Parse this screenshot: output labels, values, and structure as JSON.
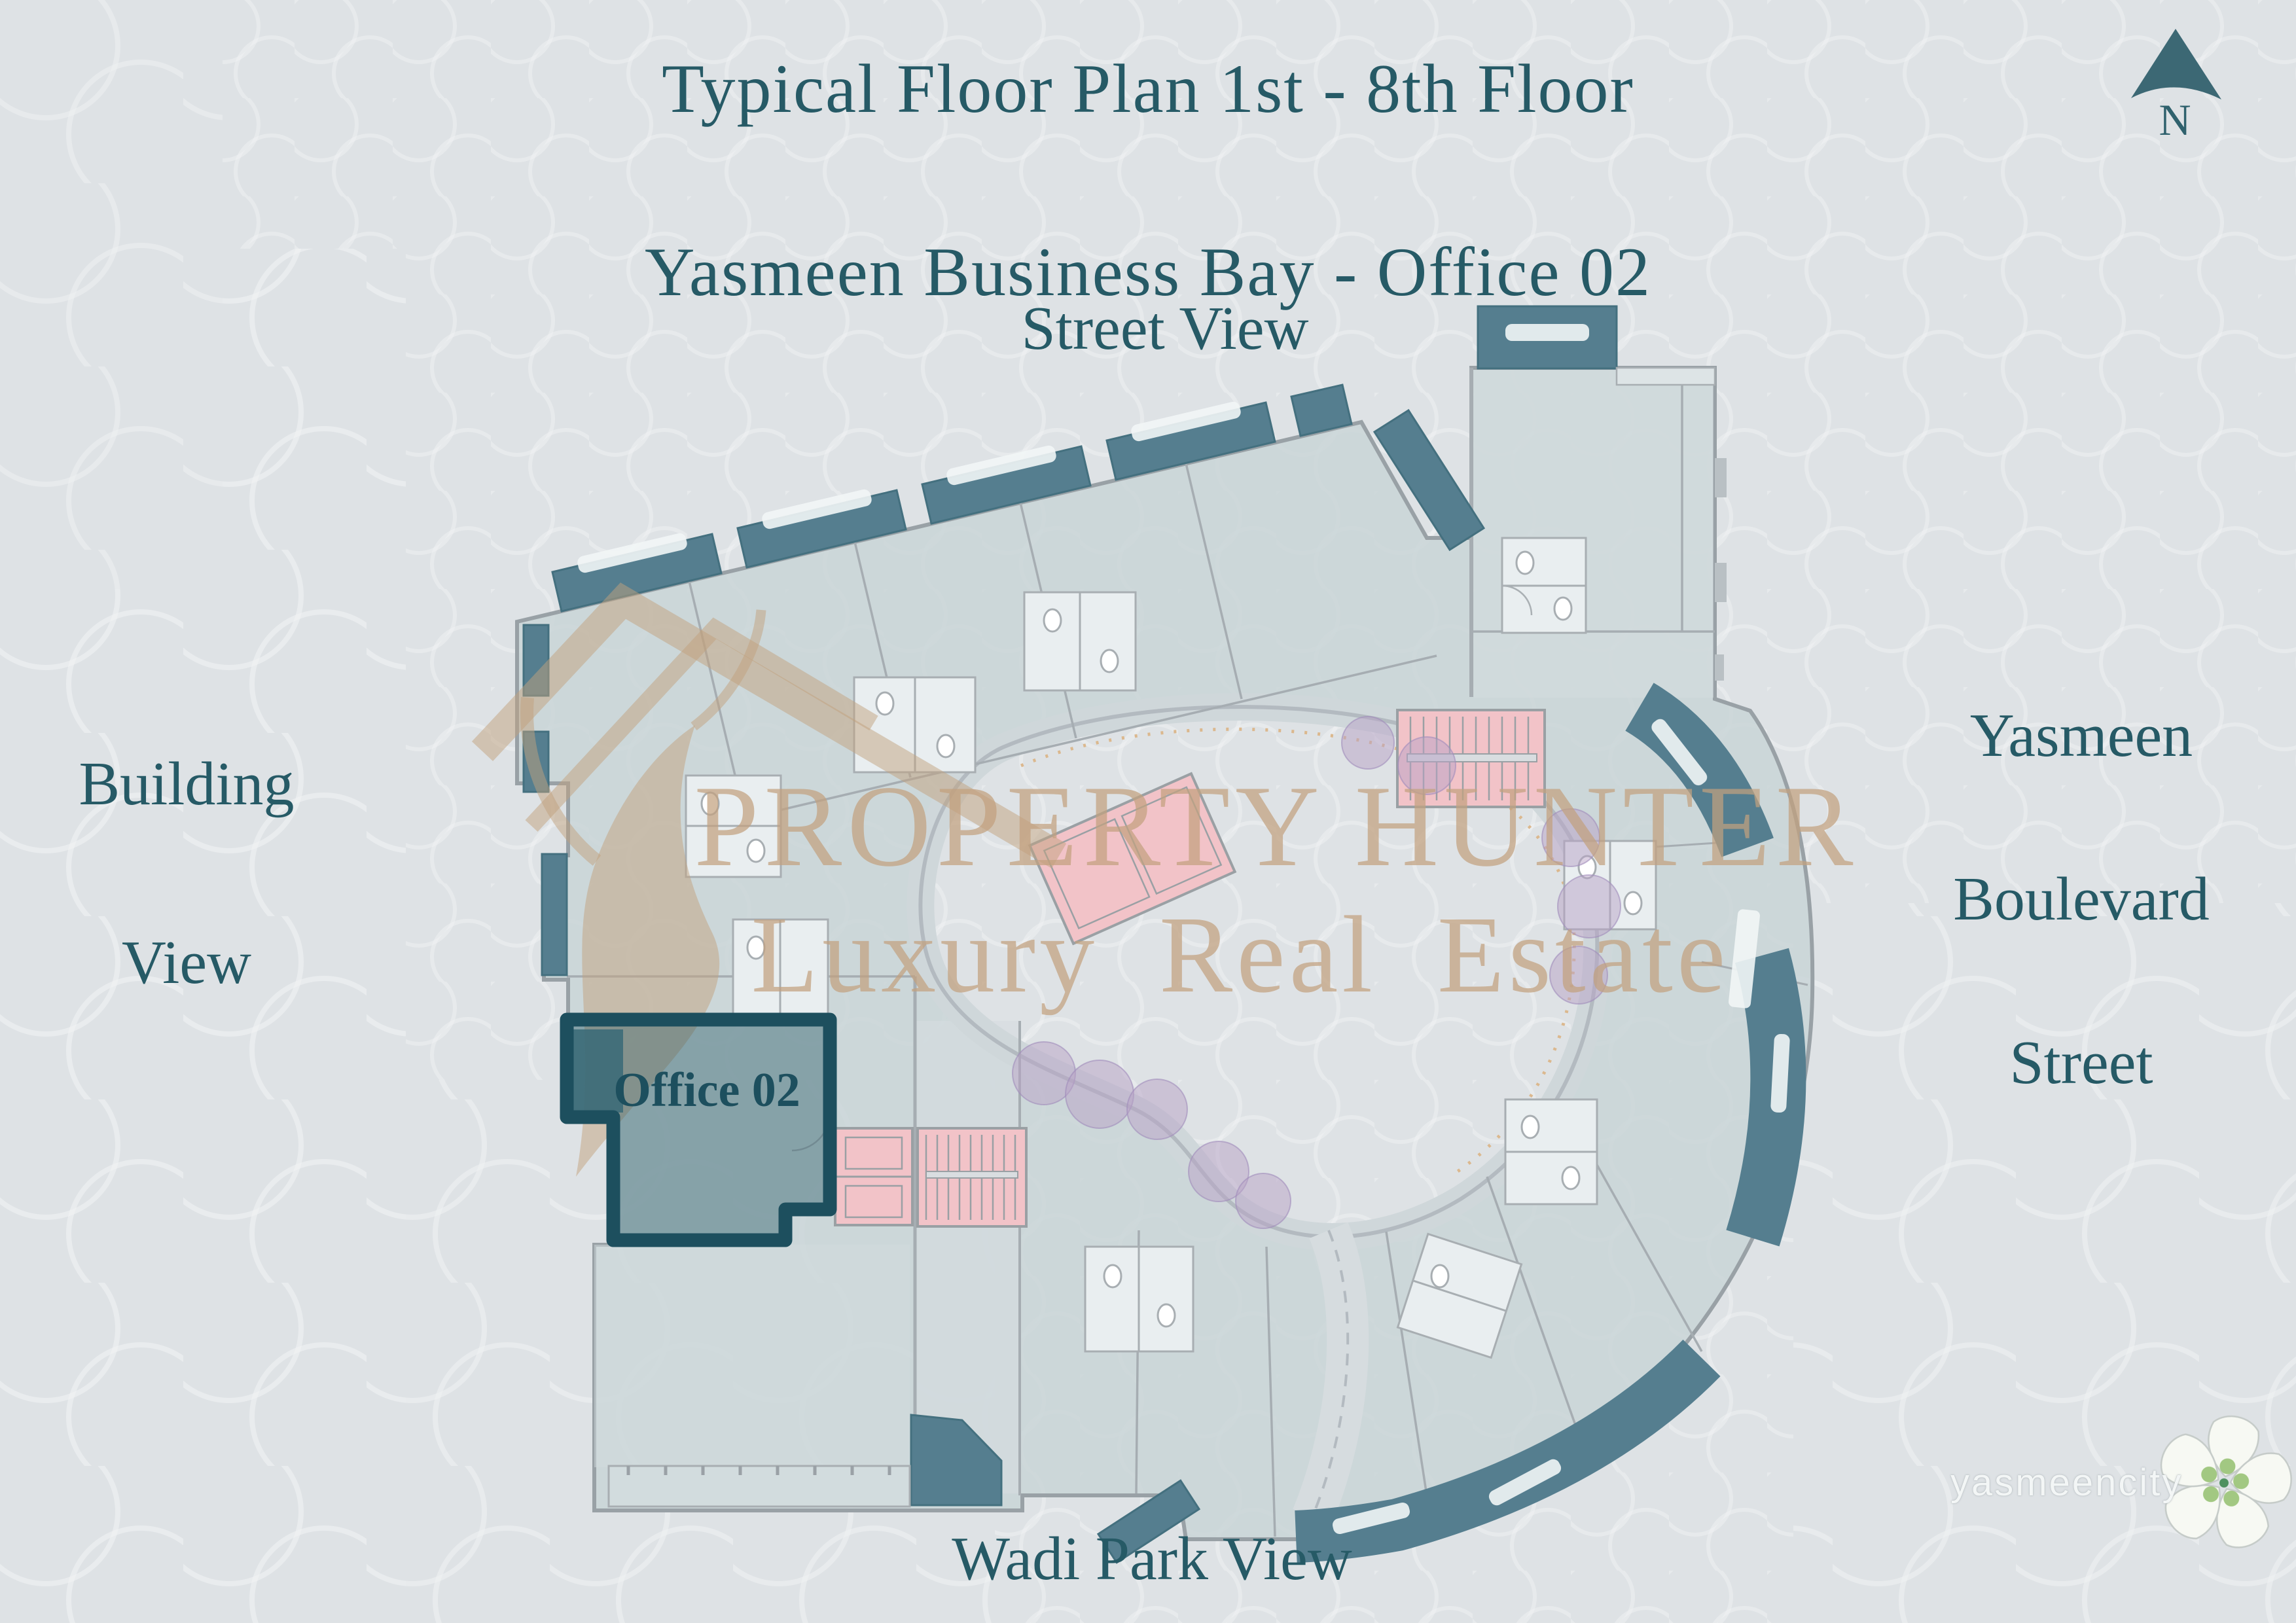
{
  "title": {
    "line1": "Typical Floor Plan 1st - 8th Floor",
    "line2": "Yasmeen Business Bay - Office 02"
  },
  "compass": {
    "label": "N"
  },
  "view_labels": {
    "top": "Street View",
    "left": {
      "line1": "Building",
      "line2": "View"
    },
    "right": {
      "line1": "Yasmeen",
      "line2": "Boulevard",
      "line3": "Street"
    },
    "bottom": "Wadi Park View"
  },
  "floor_plan": {
    "highlighted_unit": {
      "label": "Office 02"
    }
  },
  "watermark": {
    "line1": "PROPERTY HUNTER",
    "line2": "Luxury Real Estate"
  },
  "brand": {
    "logo_text": "yasmeencity"
  },
  "colors": {
    "background": "#dee2e5",
    "plan_fill": "#c9d5d7",
    "balcony_teal": "#557e8f",
    "highlight_border": "#1d4f5e",
    "stair_pink": "#f2c3c8",
    "bush_purple": "#b7a2c6",
    "watermark_gold": "#c2a17e",
    "label_teal": "#265a66"
  }
}
